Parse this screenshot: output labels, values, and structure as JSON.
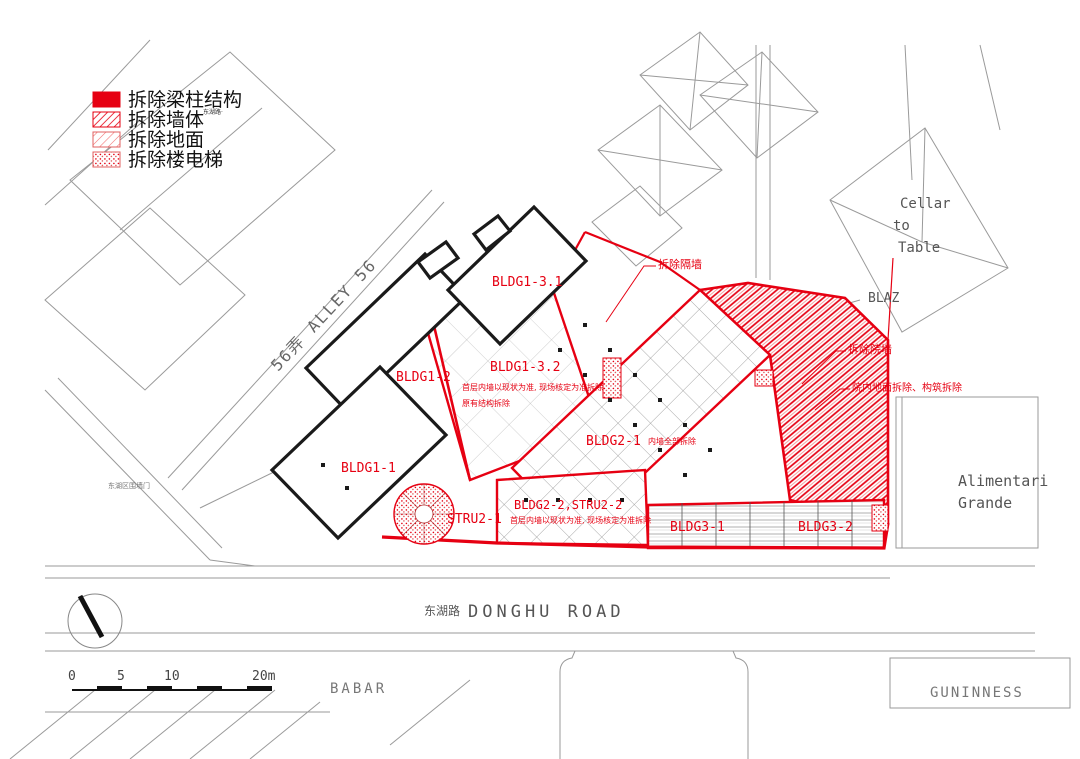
{
  "colors": {
    "red": "#e60012",
    "light_red": "#f26d6d",
    "black": "#1a1a1a",
    "gray": "#9a9a9a",
    "text_gray": "#666666"
  },
  "legend": {
    "item1": "拆除梁柱结构",
    "item2": "拆除墙体",
    "item3": "拆除地面",
    "item4": "拆除楼电梯",
    "stamp": "东湖路·"
  },
  "buildings": {
    "b11": "BLDG1-1",
    "b12": "BLDG1-2",
    "b131": "BLDG1-3.1",
    "b132": "BLDG1-3.2",
    "b21": "BLDG2-1",
    "b21_note": "内墙全部拆除",
    "b22": "BLDG2-2,STRU2-2",
    "s21": "STRU2-1",
    "b31": "BLDG3-1",
    "b32": "BLDG3-2"
  },
  "notes": {
    "n1a": "首层内墙以现状为准, 现场核定为准拆除",
    "n1b": "原有结构拆除",
    "n2": "首层内墙以现状为准, 现场核定为准拆除"
  },
  "annotations": {
    "a1": "拆除隔墙",
    "a2": "拆除院墙",
    "a3": "院内地面拆除、构筑拆除"
  },
  "streets": {
    "alley": "56弄  ALLEY 56",
    "donghu_zh": "东湖路",
    "donghu_en": "DONGHU ROAD",
    "gate": "东湖区围墙门"
  },
  "context": {
    "cellar1": "Cellar",
    "cellar2": "to",
    "cellar3": "Table",
    "blaz": "BLAZ",
    "alimentari1": "Alimentari",
    "alimentari2": "Grande",
    "babar": "BABAR",
    "guninness": "GUNINNESS"
  },
  "scalebar": {
    "t0": "0",
    "t1": "5",
    "t2": "10",
    "t3": "20m"
  }
}
